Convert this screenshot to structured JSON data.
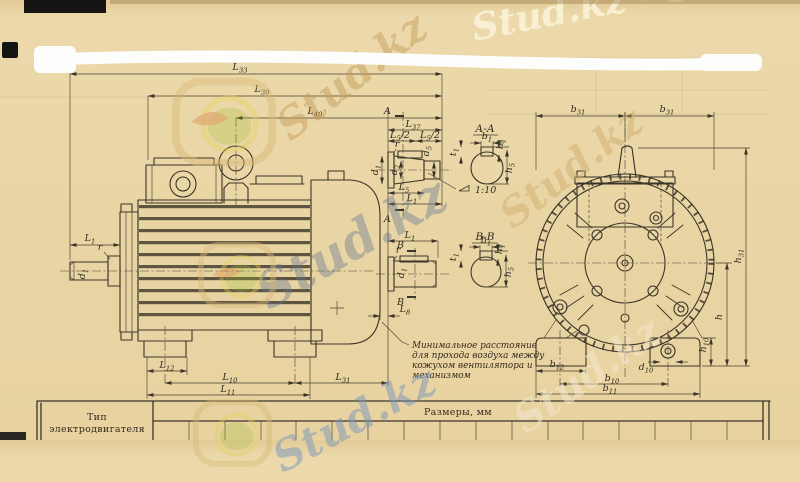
{
  "page": {
    "background": "#e9d5a4",
    "ink": "#3b3428"
  },
  "watermark": {
    "brand": "Stud.kz",
    "top_right": "Stud.kz - Stud"
  },
  "labels": {
    "L33": {
      "m": "L",
      "s": "33"
    },
    "L30": {
      "m": "L",
      "s": "30"
    },
    "L40": {
      "m": "L",
      "s": "40"
    },
    "L37": {
      "m": "L",
      "s": "37"
    },
    "L5_2": {
      "m": "L",
      "s": "5",
      "x": "/2"
    },
    "L5": {
      "m": "L",
      "s": "5"
    },
    "L1": {
      "m": "L",
      "s": "1"
    },
    "L8": {
      "m": "L",
      "s": "8"
    },
    "L12": {
      "m": "L",
      "s": "12"
    },
    "L10": {
      "m": "L",
      "s": "10"
    },
    "L31": {
      "m": "L",
      "s": "31"
    },
    "L11": {
      "m": "L",
      "s": "11"
    },
    "r": {
      "m": "r"
    },
    "d1": {
      "m": "d",
      "s": "1"
    },
    "d2": {
      "m": "d",
      "s": "2"
    },
    "d5": {
      "m": "d",
      "s": "5"
    },
    "d10": {
      "m": "d",
      "s": "10"
    },
    "A": {
      "m": "А"
    },
    "B": {
      "m": "В"
    },
    "AA": {
      "m": "А-А"
    },
    "BB": {
      "m": "В-В"
    },
    "taper": {
      "m": "1:10"
    },
    "t1": {
      "m": "t",
      "s": "1"
    },
    "b1": {
      "m": "b",
      "s": "1"
    },
    "h1": {
      "m": "h",
      "s": "1"
    },
    "h5": {
      "m": "h",
      "s": "5"
    },
    "b31": {
      "m": "b",
      "s": "31"
    },
    "h31": {
      "m": "h",
      "s": "31"
    },
    "h": {
      "m": "h"
    },
    "h10": {
      "m": "h",
      "s": "10"
    },
    "b12": {
      "m": "b",
      "s": "12"
    },
    "b10": {
      "m": "b",
      "s": "10"
    },
    "b11": {
      "m": "b",
      "s": "11"
    }
  },
  "annotation": {
    "line1": "Минимальное расстояние",
    "line2": "для прохода воздуха между",
    "line3": "кожухом вентилятора и",
    "line4": "механизмом"
  },
  "table": {
    "type_line1": "Тип",
    "type_line2": "электродвигателя",
    "sizes_header": "Размеры, мм"
  }
}
